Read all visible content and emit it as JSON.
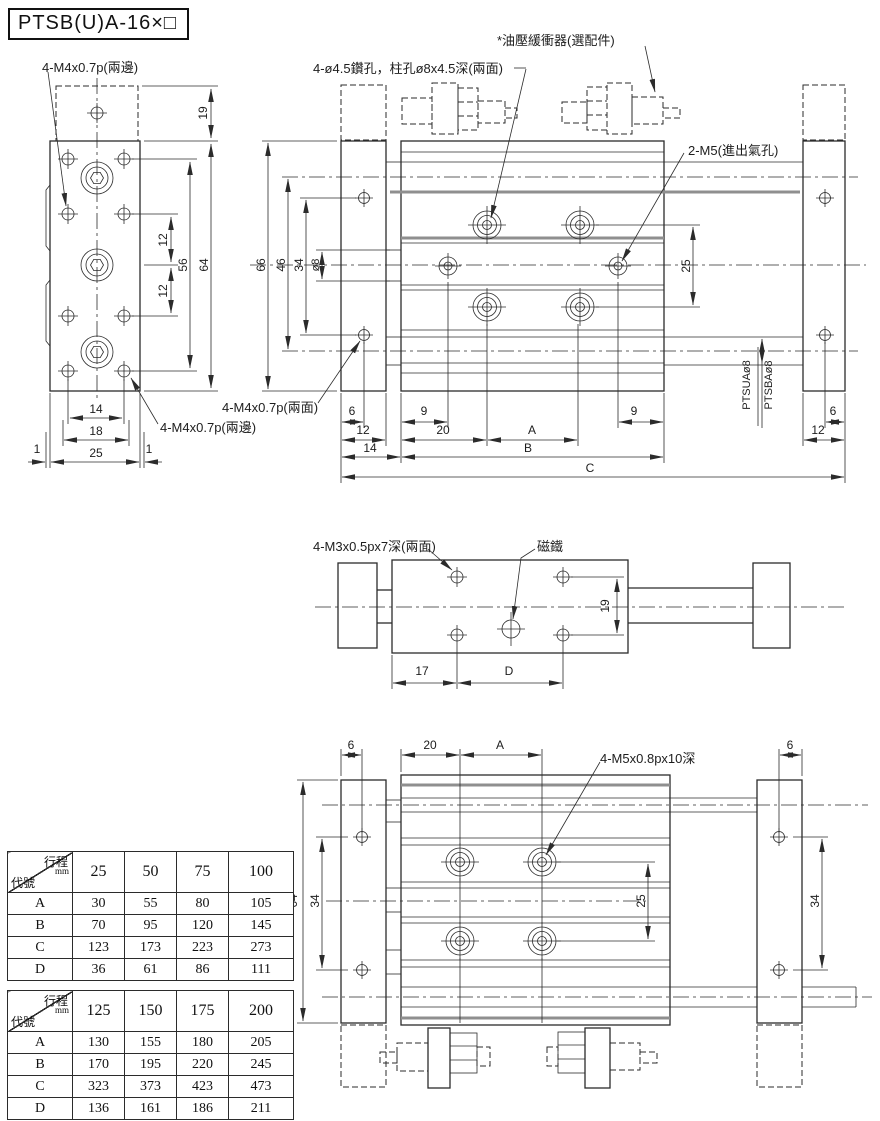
{
  "title": "PTSB(U)A-16×□",
  "annotations": {
    "m4_top": "4-M4x0.7p(兩邊)",
    "drill": "4-ø4.5鑽孔，柱孔ø8x4.5深(兩面)",
    "shock": "*油壓緩衝器(選配件)",
    "ports": "2-M5(進出氣孔)",
    "m4_faces": "4-M4x0.7p(兩面)",
    "m4_bottom": "4-M4x0.7p(兩邊)",
    "m3": "4-M3x0.5px7深(兩面)",
    "magnet": "磁鐵",
    "m5deep": "4-M5x0.8px10深",
    "ptsua": "PTSUAø8",
    "ptsba": "PTSBAø8"
  },
  "dims": {
    "lv19": "19",
    "lv12a": "12",
    "lv12b": "12",
    "lv56": "56",
    "lv64": "64",
    "lv14": "14",
    "lv18": "18",
    "lv25": "25",
    "lv1a": "1",
    "lv1b": "1",
    "mv66": "66",
    "mv46": "46",
    "mv34": "34",
    "mvd8": "ø8",
    "mv25": "25",
    "mv6l": "6",
    "mv12l": "12",
    "mv14l": "14",
    "mv9a": "9",
    "mv20": "20",
    "mvA": "A",
    "mv9b": "9",
    "mvB": "B",
    "mvC": "C",
    "mv6r": "6",
    "mv12r": "12",
    "sv19": "19",
    "sv17": "17",
    "svD": "D",
    "bv6l": "6",
    "bv20": "20",
    "bvA": "A",
    "bv6r": "6",
    "bv64": "64",
    "bv34l": "34",
    "bv25": "25",
    "bv34r": "34"
  },
  "tables": [
    {
      "corner_top": "行程",
      "corner_unit": "mm",
      "corner_bottom": "代號",
      "cols": [
        "25",
        "50",
        "75",
        "100"
      ],
      "rows": [
        {
          "label": "A",
          "values": [
            "30",
            "55",
            "80",
            "105"
          ]
        },
        {
          "label": "B",
          "values": [
            "70",
            "95",
            "120",
            "145"
          ]
        },
        {
          "label": "C",
          "values": [
            "123",
            "173",
            "223",
            "273"
          ]
        },
        {
          "label": "D",
          "values": [
            "36",
            "61",
            "86",
            "111"
          ]
        }
      ]
    },
    {
      "corner_top": "行程",
      "corner_unit": "mm",
      "corner_bottom": "代號",
      "cols": [
        "125",
        "150",
        "175",
        "200"
      ],
      "rows": [
        {
          "label": "A",
          "values": [
            "130",
            "155",
            "180",
            "205"
          ]
        },
        {
          "label": "B",
          "values": [
            "170",
            "195",
            "220",
            "245"
          ]
        },
        {
          "label": "C",
          "values": [
            "323",
            "373",
            "423",
            "473"
          ]
        },
        {
          "label": "D",
          "values": [
            "136",
            "161",
            "186",
            "211"
          ]
        }
      ]
    }
  ]
}
